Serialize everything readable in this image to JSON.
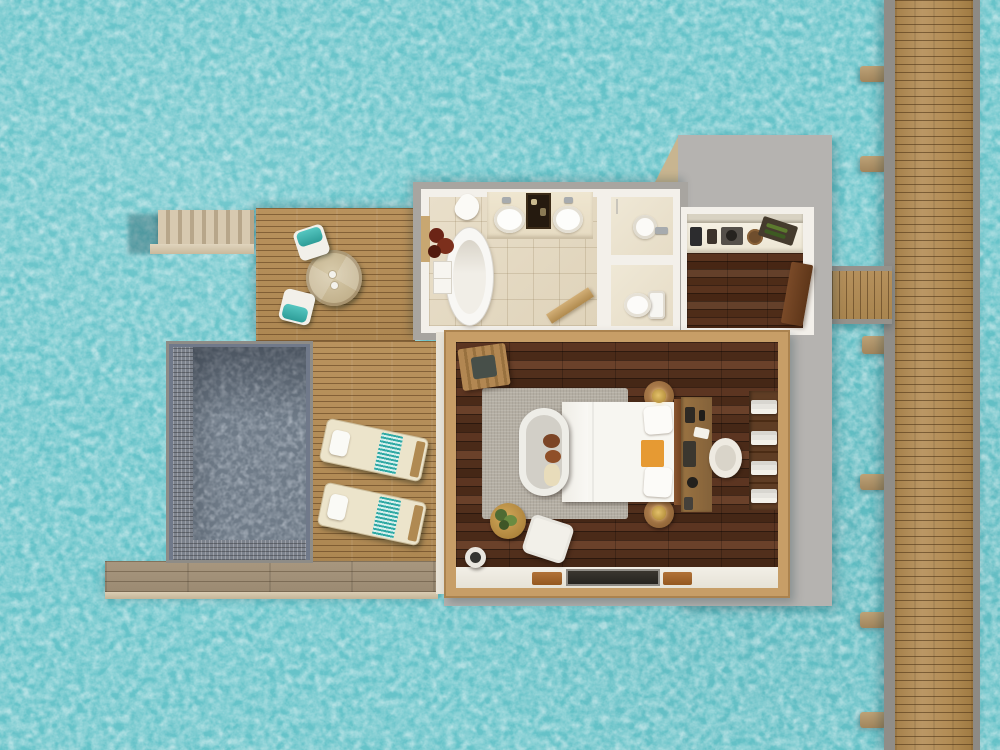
{
  "scene": {
    "title": "Overwater villa floor plan — top-down 3D render",
    "view": "top-down aerial",
    "environment": {
      "label": "Lagoon water",
      "water_color": "#68c3c9"
    },
    "palette": {
      "ocean": "#68c3c9",
      "jetty_wood": "#b28c55",
      "deck_wood": "#b9925d",
      "boardwalk_wood": "#a8977f",
      "pool_water": "#6f7b88",
      "roof_gray": "#b5b3b0",
      "wall_white": "#f3f0ea",
      "bedroom_floor": "#4a2a18",
      "frame_wood": "#c79e67",
      "accent_teal": "#3db3ae",
      "accent_orange": "#e69a33"
    },
    "areas": {
      "jetty": {
        "label": "Main jetty walkway",
        "support_beams": 6
      },
      "connector": {
        "label": "Entrance walkway to villa"
      },
      "entry_roof": {
        "label": "Covered entry roof"
      },
      "bathroom": {
        "label": "Bathroom",
        "furniture": [
          "freestanding oval bathtub",
          "double vanity with two sinks",
          "amenity tray",
          "potted plant",
          "side cabinet",
          "dropped towel",
          "door to deck",
          "door to bedroom"
        ]
      },
      "shower_room": {
        "label": "Shower room",
        "furniture": [
          "round basin",
          "wall faucet",
          "shower pipe"
        ]
      },
      "wc_room": {
        "label": "WC",
        "furniture": [
          "toilet with tank"
        ]
      },
      "pantry": {
        "label": "Minibar pantry",
        "furniture": [
          "espresso machine",
          "capsule box",
          "kettle tray",
          "round tray",
          "wine bottle crate",
          "open wooden door"
        ]
      },
      "bedroom": {
        "label": "Bedroom",
        "furniture": [
          "king bed with white duvet",
          "two pillows",
          "orange throw",
          "headboard",
          "two round nightstands with lamps",
          "writing desk",
          "desk chair",
          "towel shelf unit",
          "luggage bench",
          "area rug",
          "cushioned daybed with towel art",
          "round side table with plant",
          "ottoman",
          "basket",
          "sliding glass door",
          "two doormats"
        ]
      },
      "pool": {
        "label": "Private plunge pool",
        "features": [
          "mosaic tile border",
          "gray coping"
        ]
      },
      "sun_deck": {
        "label": "Sun deck",
        "furniture": [
          "two sun loungers with teal striped towels and white pillows"
        ]
      },
      "dining_deck": {
        "label": "Outdoor dining deck",
        "furniture": [
          "round wooden table with two glasses",
          "two chairs with teal cushions"
        ]
      },
      "stairs": {
        "label": "Sea access steps",
        "steps": 8
      },
      "boardwalk": {
        "label": "Lower boardwalk ledge"
      }
    }
  }
}
